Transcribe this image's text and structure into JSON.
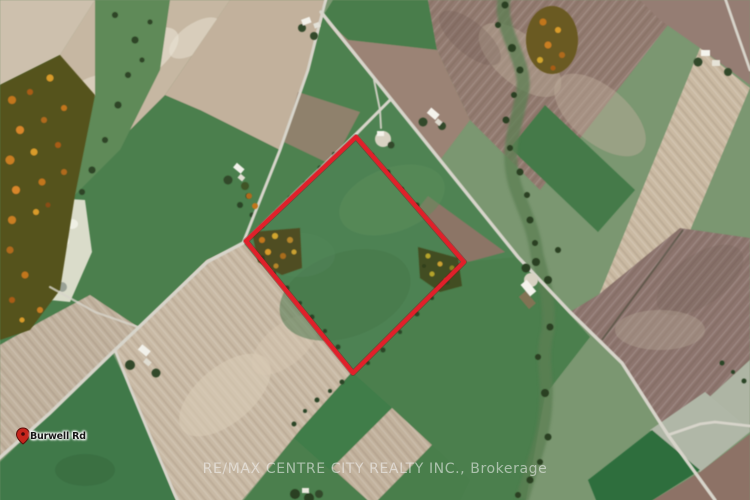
{
  "map": {
    "road_label": "Burwell Rd",
    "watermark_text": "RE/MAX CENTRE CITY REALTY INC., Brokerage",
    "boundary": {
      "points": "356,137 464,262 353,373 246,241",
      "color": "#e0202a",
      "underlay_color": "#8e1016"
    },
    "pin": {
      "x": 23,
      "y": 428,
      "color": "#c6251d",
      "outline": "#5e0f0c"
    },
    "label_pos": {
      "x": 30,
      "y": 431
    },
    "road_color": "#d7d4ca"
  }
}
